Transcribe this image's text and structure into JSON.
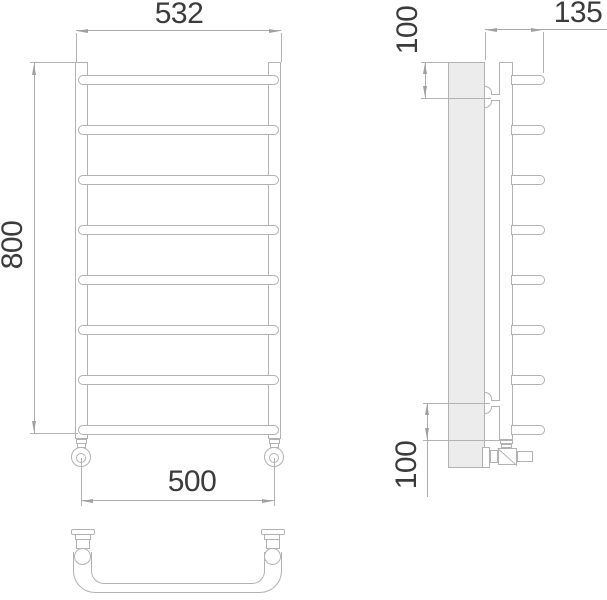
{
  "drawing": {
    "title": "ladder towel rail technical drawing",
    "views": {
      "front": {
        "name": "front-view",
        "bar_count": 8
      },
      "side": {
        "name": "side-view",
        "rung_count": 8
      },
      "bottom": {
        "name": "bottom-view"
      }
    },
    "dimensions": {
      "front_width": "532",
      "front_height": "800",
      "pipe_spacing": "500",
      "side_depth": "135",
      "side_top_offset": "100",
      "side_bottom_offset": "100"
    },
    "colors": {
      "object_line": "#b2b2b2",
      "dimension_line": "#ababab",
      "arrow": "#a0a0a0",
      "text": "#3b3b3b",
      "wall_fill": "#ececec"
    }
  }
}
